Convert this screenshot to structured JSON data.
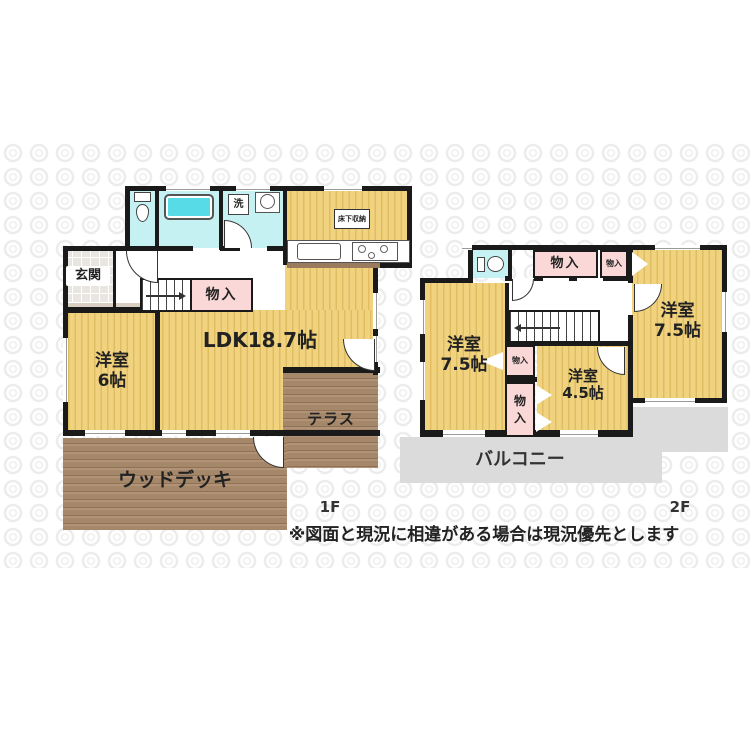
{
  "colors": {
    "room_yellow": "#F1D37F",
    "room_yellow_stripe": "#DFBE63",
    "closet_pink": "#FAD8D8",
    "water_cyan": "#C6F1F3",
    "bathtub_cyan": "#57DBE7",
    "wood_brown": "#A58769",
    "wood_brown_dark": "#8F7156",
    "wood_brown_light": "#B29377",
    "balcony_gray": "#DBDBDB",
    "wall_black": "#1A1A1A",
    "tile_gray": "#E9E6E2",
    "step_beige": "#D8CEC2"
  },
  "floor1": {
    "floor_label": "1F",
    "genkan": "玄関",
    "laundry": "洗",
    "underfloor_storage": "床下収納",
    "storage": "物入",
    "ldk": "LDK18.7帖",
    "bedroom_name": "洋室",
    "bedroom_size": "6帖",
    "terrace": "テラス",
    "wood_deck": "ウッドデッキ"
  },
  "floor2": {
    "floor_label": "2F",
    "storage_a": "物入",
    "storage_b": "物入",
    "storage_c": "物入",
    "storage_d": "物入",
    "bedroom_left_name": "洋室",
    "bedroom_left_size": "7.5帖",
    "bedroom_center_name": "洋室",
    "bedroom_center_size": "4.5帖",
    "bedroom_right_name": "洋室",
    "bedroom_right_size": "7.5帖",
    "balcony": "バルコニー"
  },
  "disclaimer": "※図面と現況に相違がある場合は現況優先とします"
}
